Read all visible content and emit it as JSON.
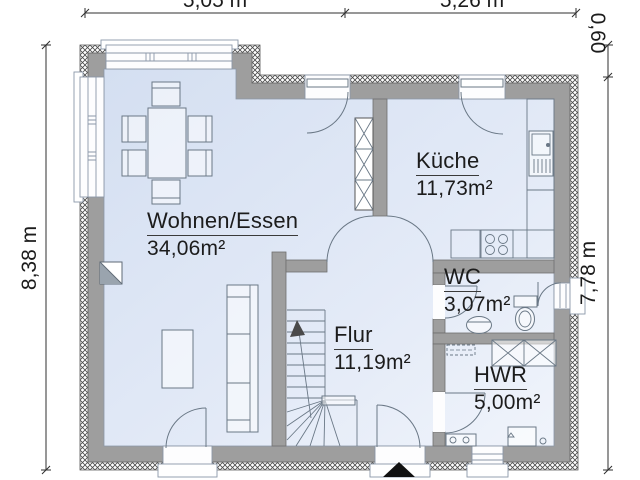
{
  "rooms": [
    {
      "id": "wohnen",
      "name": "Wohnen/Essen",
      "area": "34,06m²"
    },
    {
      "id": "kueche",
      "name": "Küche",
      "area": "11,73m²"
    },
    {
      "id": "wc",
      "name": "WC",
      "area": "3,07m²"
    },
    {
      "id": "flur",
      "name": "Flur",
      "area": "11,19m²"
    },
    {
      "id": "hwr",
      "name": "HWR",
      "area": "5,00m²"
    }
  ],
  "dimensions": {
    "top_left": "5,05 m",
    "top_right": "5,26 m",
    "left": "8,38 m",
    "right": "7,78 m",
    "right_offset": "0,60"
  },
  "colors": {
    "floor": "#dce6f5",
    "floor2": "#eef3fb",
    "wall": "#9e9e9e",
    "fixture": "#6a7886",
    "dimline": "#2f2f2f",
    "text": "#1c1c1c"
  }
}
